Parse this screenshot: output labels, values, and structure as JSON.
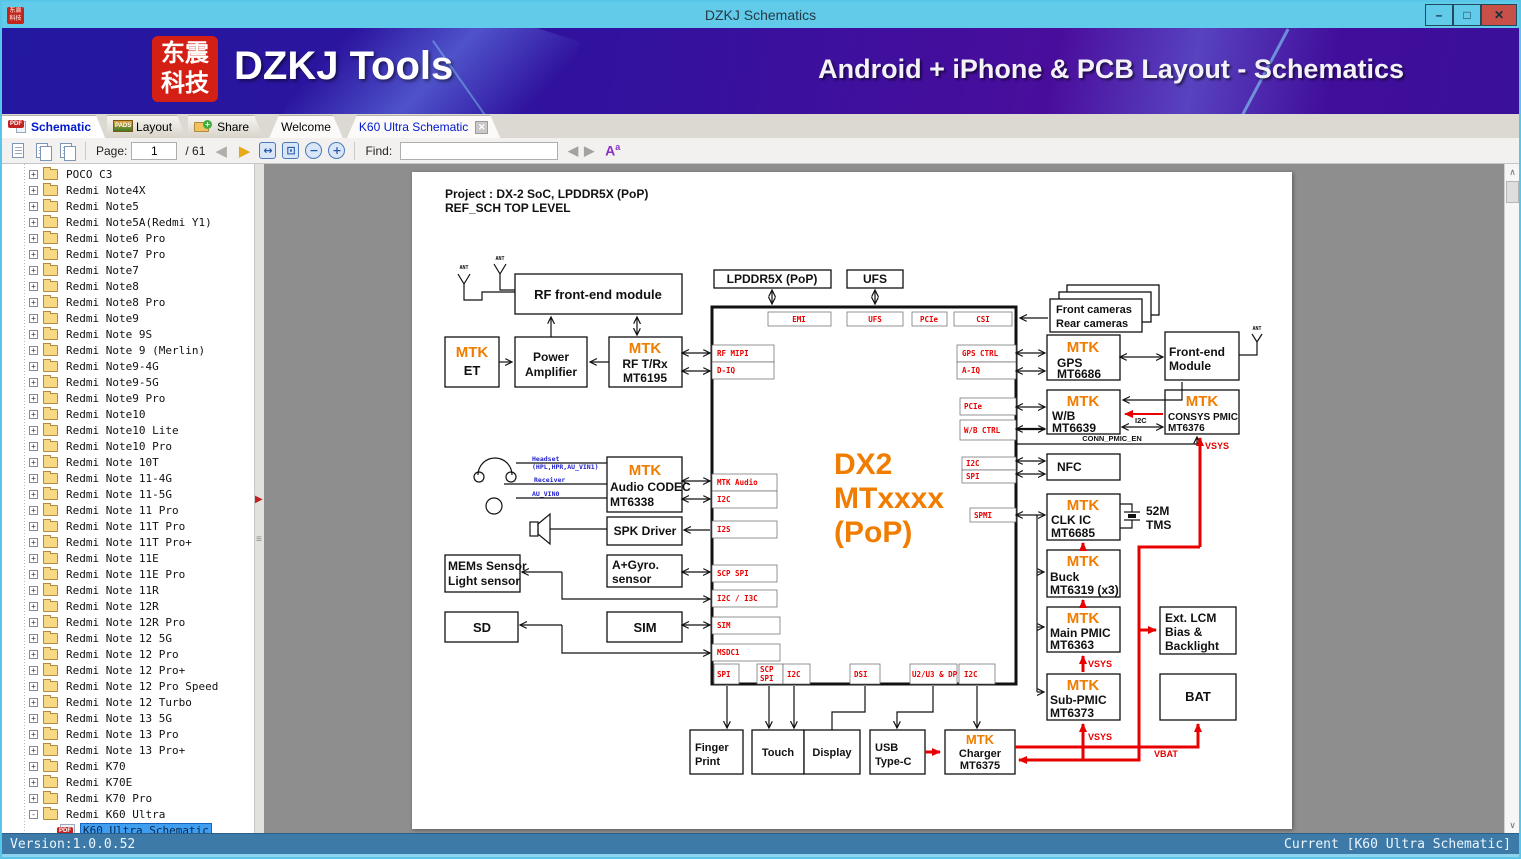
{
  "window": {
    "title": "DZKJ Schematics",
    "minimize": "–",
    "maximize": "□",
    "close": "✕"
  },
  "banner": {
    "logo_line1": "东震",
    "logo_line2": "科技",
    "title": "DZKJ Tools",
    "subtitle": "Android + iPhone & PCB Layout - Schematics"
  },
  "icons": {
    "pdf_badge": "PDF",
    "pads_badge": "PADS",
    "font_a": "A",
    "font_a_sup": "a",
    "prev_tri": "◀",
    "next_tri": "▶",
    "find_prev": "◀",
    "find_next": "▶",
    "fit_width": "↔",
    "fit_page": "⊡",
    "zoom_out": "−",
    "zoom_in": "+",
    "up_arrow": "∧",
    "down_arrow": "∨",
    "splitter_arrow": "▶",
    "grip": "≡"
  },
  "tabs": {
    "app": [
      {
        "label": "Schematic"
      },
      {
        "label": "Layout"
      },
      {
        "label": "Share"
      }
    ],
    "docs": [
      {
        "label": "Welcome"
      },
      {
        "label": "K60 Ultra Schematic",
        "close": "✕"
      }
    ]
  },
  "toolbar": {
    "page_label": "Page:",
    "page_value": "1",
    "page_total": "/ 61",
    "find_label": "Find:",
    "find_value": ""
  },
  "sidebar": {
    "items": [
      {
        "label": "POCO C3",
        "icon": "folder",
        "toggle": "+"
      },
      {
        "label": "Redmi Note4X",
        "icon": "folder",
        "toggle": "+"
      },
      {
        "label": "Redmi Note5",
        "icon": "folder",
        "toggle": "+"
      },
      {
        "label": "Redmi Note5A(Redmi Y1)",
        "icon": "folder",
        "toggle": "+"
      },
      {
        "label": "Redmi Note6 Pro",
        "icon": "folder",
        "toggle": "+"
      },
      {
        "label": "Redmi Note7 Pro",
        "icon": "folder",
        "toggle": "+"
      },
      {
        "label": "Redmi Note7",
        "icon": "folder",
        "toggle": "+"
      },
      {
        "label": "Redmi Note8",
        "icon": "folder",
        "toggle": "+"
      },
      {
        "label": "Redmi Note8 Pro",
        "icon": "folder",
        "toggle": "+"
      },
      {
        "label": "Redmi Note9",
        "icon": "folder",
        "toggle": "+"
      },
      {
        "label": "Redmi Note 9S",
        "icon": "folder",
        "toggle": "+"
      },
      {
        "label": "Redmi Note 9 (Merlin)",
        "icon": "folder",
        "toggle": "+"
      },
      {
        "label": "Redmi Note9-4G",
        "icon": "folder",
        "toggle": "+"
      },
      {
        "label": "Redmi Note9-5G",
        "icon": "folder",
        "toggle": "+"
      },
      {
        "label": "Redmi Note9 Pro",
        "icon": "folder",
        "toggle": "+"
      },
      {
        "label": "Redmi Note10",
        "icon": "folder",
        "toggle": "+"
      },
      {
        "label": "Redmi Note10 Lite",
        "icon": "folder",
        "toggle": "+"
      },
      {
        "label": "Redmi Note10 Pro",
        "icon": "folder",
        "toggle": "+"
      },
      {
        "label": "Redmi Note 10T",
        "icon": "folder",
        "toggle": "+"
      },
      {
        "label": "Redmi Note 11-4G",
        "icon": "folder",
        "toggle": "+"
      },
      {
        "label": "Redmi Note 11-5G",
        "icon": "folder",
        "toggle": "+"
      },
      {
        "label": "Redmi Note 11 Pro",
        "icon": "folder",
        "toggle": "+"
      },
      {
        "label": "Redmi Note 11T Pro",
        "icon": "folder",
        "toggle": "+"
      },
      {
        "label": "Redmi Note 11T Pro+",
        "icon": "folder",
        "toggle": "+"
      },
      {
        "label": "Redmi Note 11E",
        "icon": "folder",
        "toggle": "+"
      },
      {
        "label": "Redmi Note 11E Pro",
        "icon": "folder",
        "toggle": "+"
      },
      {
        "label": "Redmi Note 11R",
        "icon": "folder",
        "toggle": "+"
      },
      {
        "label": "Redmi Note 12R",
        "icon": "folder",
        "toggle": "+"
      },
      {
        "label": "Redmi Note 12R Pro",
        "icon": "folder",
        "toggle": "+"
      },
      {
        "label": "Redmi Note 12 5G",
        "icon": "folder",
        "toggle": "+"
      },
      {
        "label": "Redmi Note 12 Pro",
        "icon": "folder",
        "toggle": "+"
      },
      {
        "label": "Redmi Note 12 Pro+",
        "icon": "folder",
        "toggle": "+"
      },
      {
        "label": "Redmi Note 12 Pro Speed",
        "icon": "folder",
        "toggle": "+"
      },
      {
        "label": "Redmi Note 12 Turbo",
        "icon": "folder",
        "toggle": "+"
      },
      {
        "label": "Redmi Note 13 5G",
        "icon": "folder",
        "toggle": "+"
      },
      {
        "label": "Redmi Note 13 Pro",
        "icon": "folder",
        "toggle": "+"
      },
      {
        "label": "Redmi Note 13 Pro+",
        "icon": "folder",
        "toggle": "+"
      },
      {
        "label": "Redmi K70",
        "icon": "folder",
        "toggle": "+"
      },
      {
        "label": "Redmi K70E",
        "icon": "folder",
        "toggle": "+"
      },
      {
        "label": "Redmi K70 Pro",
        "icon": "folder",
        "toggle": "+"
      },
      {
        "label": "Redmi K60 Ultra",
        "icon": "folder",
        "toggle": "-"
      },
      {
        "label": "K60 Ultra Schematic",
        "icon": "pdf",
        "child": true,
        "selected": true
      },
      {
        "label": "K60 Ultra Layout",
        "icon": "pdf",
        "child": true
      },
      {
        "label": "",
        "icon": "folder",
        "toggle": "+"
      }
    ]
  },
  "statusbar": {
    "left": "Version:1.0.0.52",
    "right": "Current [K60 Ultra Schematic]"
  },
  "schematic": {
    "title_line1": "Project : DX-2 SoC, LPDDR5X (PoP)",
    "title_line2": "REF_SCH TOP LEVEL",
    "brand": "MTK",
    "blocks": {
      "rf_fe": "RF  front-end module",
      "lpddr": "LPDDR5X (PoP)",
      "ufs_top": "UFS",
      "et": "ET",
      "pa1": "Power",
      "pa2": "Amplifier",
      "rftrx1": "RF T/Rx",
      "rftrx2": "MT6195",
      "codec1": "Audio CODEC",
      "codec2": "MT6338",
      "spk": "SPK Driver",
      "gyro1": "A+Gyro.",
      "gyro2": "sensor",
      "mems1": "MEMs Sensor",
      "mems2": "Light sensor",
      "sd": "SD",
      "sim": "SIM",
      "finger1": "Finger",
      "finger2": "Print",
      "touch": "Touch",
      "display": "Display",
      "usb1": "USB",
      "usb2": "Type-C",
      "charger1": "Charger",
      "charger2": "MT6375",
      "cams1": "Front cameras",
      "cams2": "Rear cameras",
      "gps1": "GPS",
      "gps2": "MT6686",
      "fem1": "Front-end",
      "fem2": "Module",
      "wb1": "W/B",
      "wb2": "MT6639",
      "consys1": "CONSYS PMIC",
      "consys2": "MT6376",
      "nfc": "NFC",
      "clk1": "CLK IC",
      "clk2": "MT6685",
      "xtal1": "52M",
      "xtal2": "TMS",
      "buck1": "Buck",
      "buck2": "MT6319 (x3)",
      "main1": "Main PMIC",
      "main2": "MT6363",
      "lcm1": "Ext. LCM",
      "lcm2": "Bias &",
      "lcm3": "Backlight",
      "sub1": "Sub-PMIC",
      "sub2": "MT6373",
      "bat": "BAT",
      "chip1": "DX2",
      "chip2": "MTxxxx",
      "chip3": "(PoP)"
    },
    "ports": {
      "top_emi": "EMI",
      "top_ufs": "UFS",
      "top_pcie": "PCIe",
      "top_csi": "CSI",
      "l_rfmipi": "RF MIPI",
      "l_diq": "D-IQ",
      "l_mtkaudio": "MTK Audio",
      "l_i2c": "I2C",
      "l_i2s": "I2S",
      "l_scpspi": "SCP SPI",
      "l_i2ci3c": "I2C / I3C",
      "l_sim": "SIM",
      "l_msdc1": "MSDC1",
      "b_spi": "SPI",
      "b_scp": "SCP",
      "b_scp2": "SPI",
      "b_i2c": "I2C",
      "b_dsi": "DSI",
      "b_usb": "U2/U3 & DP",
      "b_i2c2": "I2C",
      "r_gpsctrl": "GPS CTRL",
      "r_aiq": "A-IQ",
      "r_pcie": "PCIe",
      "r_wbctrl": "W/B CTRL",
      "r_i2c": "I2C",
      "r_spi": "SPI",
      "r_spmi": "SPMI"
    },
    "nets": {
      "vsys": "VSYS",
      "vbat": "VBAT",
      "i2c": "I2C",
      "conn_pmic_en": "CONN_PMIC_EN",
      "ant": "ANT"
    },
    "audio": {
      "headset": "Headset",
      "headset2": "(HPL,HPR,AU_VIN1)",
      "receiver": "Receiver",
      "au_vin0": "AU_VIN0"
    }
  }
}
